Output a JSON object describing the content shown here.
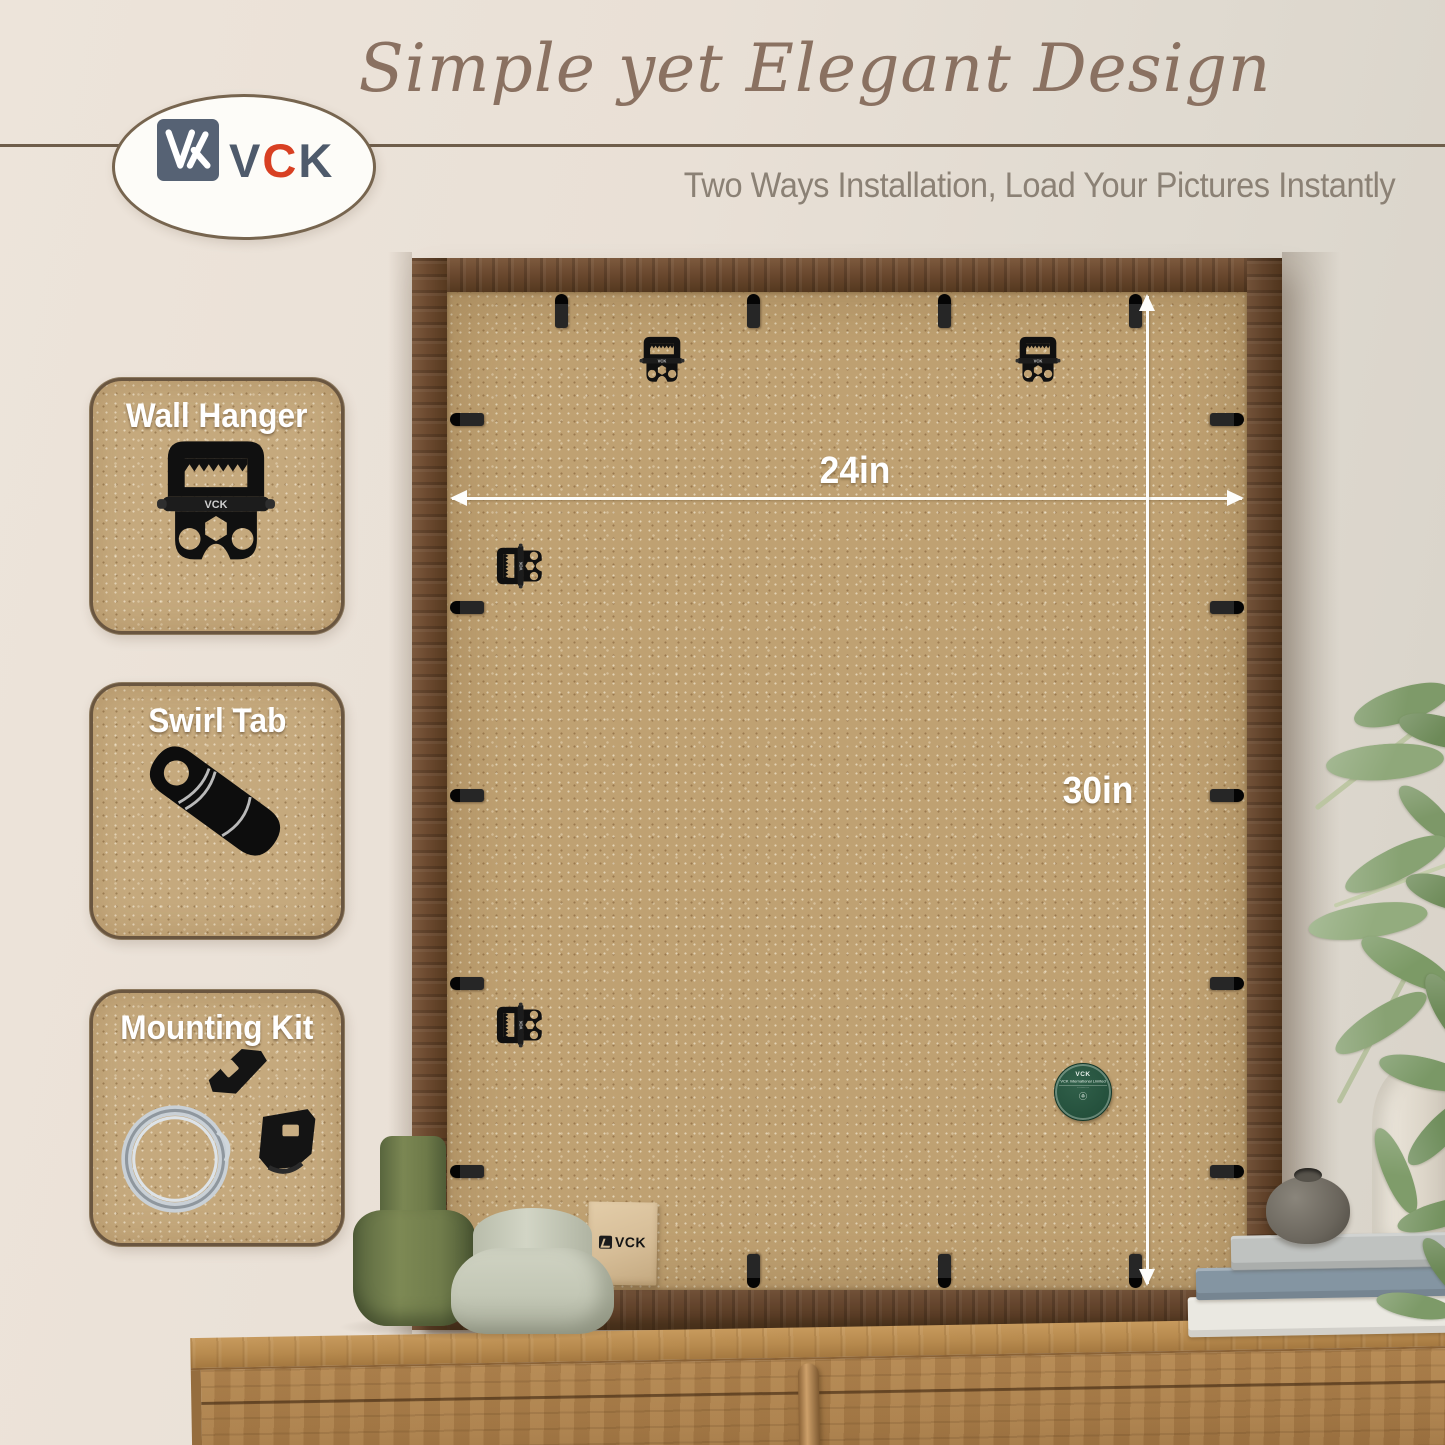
{
  "header": {
    "title": "Simple yet Elegant Design",
    "subtitle": "Two Ways Installation, Load Your Pictures Instantly"
  },
  "logo": {
    "v": "V",
    "c": "C",
    "k": "K"
  },
  "callouts": [
    {
      "label": "Wall Hanger"
    },
    {
      "label": "Swirl Tab"
    },
    {
      "label": "Mounting Kit"
    }
  ],
  "dimensions": {
    "width": "24in",
    "height": "30in"
  },
  "back_details": {
    "hardware_stamp": "VCK",
    "sticker_brand": "VCK",
    "sticker_text": "VCK International Limited",
    "envelope_brand": "VCK"
  },
  "colors": {
    "brand_slate": "#566274",
    "brand_red": "#d84023",
    "title_brown": "#8a7161",
    "frame_wood": "#6e4b33",
    "mdf_tan": "#bfa172",
    "dimension_white": "#ffffff",
    "sticker_green": "#27513d"
  }
}
